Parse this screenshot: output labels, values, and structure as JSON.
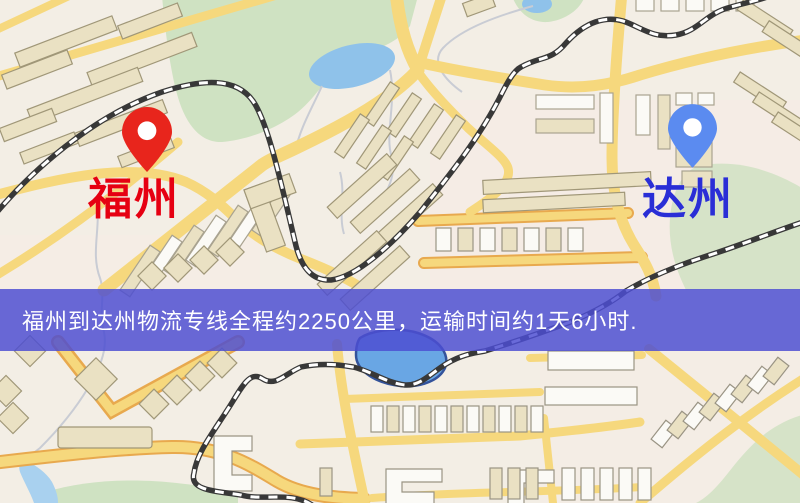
{
  "map": {
    "origin": {
      "label": "福州",
      "pin_color": "#e8251c",
      "label_color": "#e60012"
    },
    "destination": {
      "label": "达州",
      "pin_color": "#5b8bf0",
      "label_color": "#2a2ed6"
    },
    "banner": {
      "text": "福州到达州物流专线全程约2250公里，运输时间约1天6小时.",
      "background_color": "#4c4ed2",
      "text_color": "#ffffff"
    },
    "colors": {
      "background": "#f3eee5",
      "road": "#f6d87d",
      "road_casing": "#e8a94e",
      "park": "#cfe2c2",
      "water": "#8fc2ea",
      "lake": "#69a6e4",
      "railway": "#383838",
      "building": "#eae1c3"
    }
  }
}
